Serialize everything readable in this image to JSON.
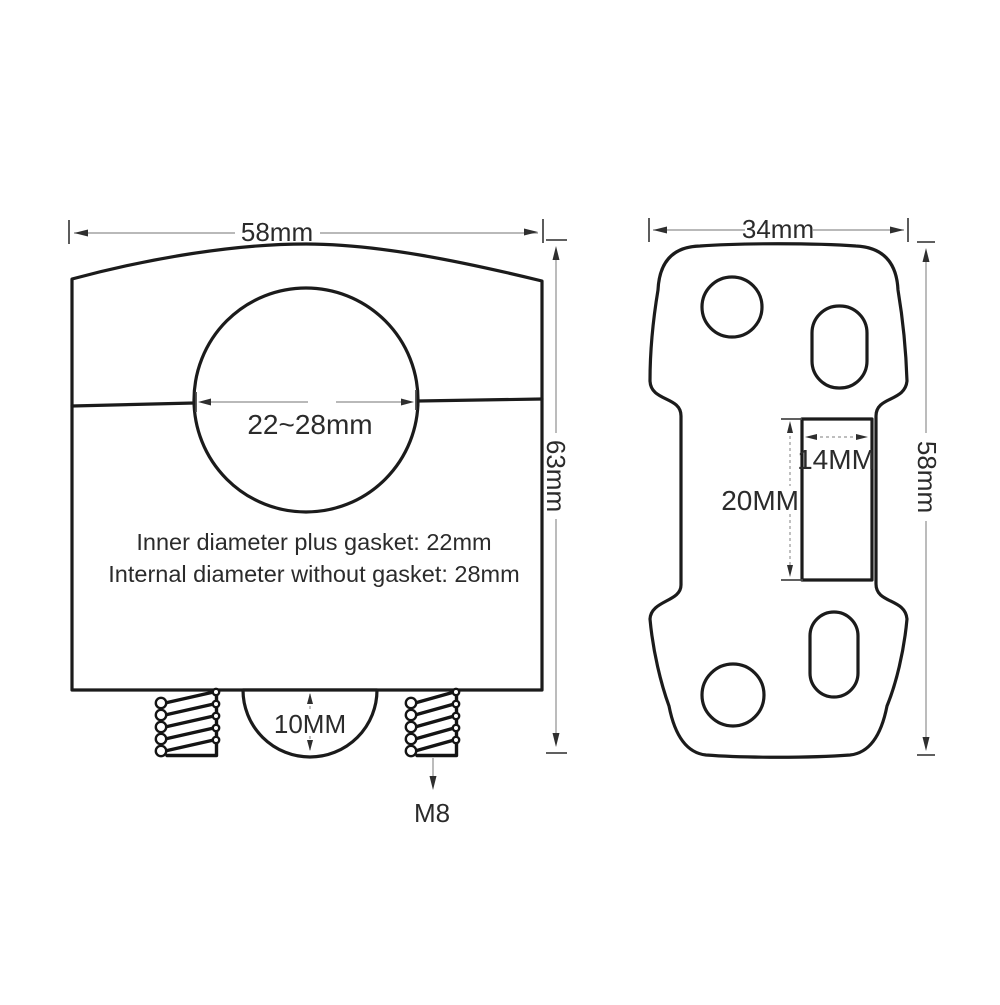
{
  "drawing": {
    "front_view": {
      "width_dim": "58mm",
      "height_dim": "63mm",
      "bore_dim": "22~28mm",
      "note_line1": "Inner diameter plus gasket: 22mm",
      "note_line2": "Internal diameter without gasket: 28mm",
      "boss_dim": "10MM",
      "bolt_thread_label": "M8"
    },
    "side_view": {
      "width_dim": "34mm",
      "height_dim": "58mm",
      "slot_width_dim": "14MM",
      "slot_length_dim": "20MM"
    },
    "colors": {
      "line": "#1b1b1b",
      "dimension_line": "#8f8f8f",
      "text": "#2b2b2b",
      "background": "#ffffff"
    }
  }
}
